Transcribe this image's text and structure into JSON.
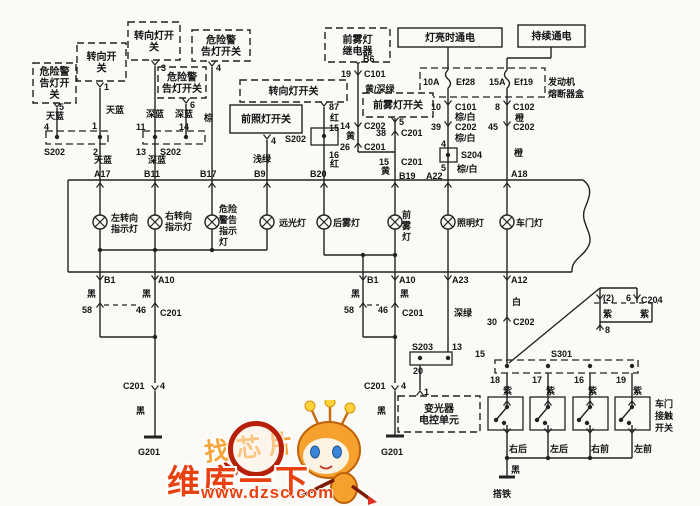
{
  "colors": {
    "line": "#222222",
    "text": "#141414",
    "bg": "#fbfaf7",
    "brand": "#e8400e",
    "slogan": "#f7a53b"
  },
  "watermark": {
    "slogan": "找芯片",
    "brand": "维库一下",
    "url": "www.dzsc.com"
  },
  "boxes": [
    {
      "n": "hazard-warning-light-switch-1",
      "lines": [
        "危险警",
        "告灯开",
        "关"
      ],
      "x": 33,
      "y": 63,
      "w": 43,
      "h": 40,
      "d": 1
    },
    {
      "n": "turn-switch",
      "lines": [
        "转向开",
        "关"
      ],
      "x": 77,
      "y": 43,
      "w": 49,
      "h": 38,
      "d": 1
    },
    {
      "n": "turn-lamp-switch-1",
      "lines": [
        "转向灯开",
        "关"
      ],
      "x": 128,
      "y": 22,
      "w": 52,
      "h": 38,
      "d": 1
    },
    {
      "n": "hazard-warning-light-switch-2",
      "lines": [
        "危险警",
        "告灯开关"
      ],
      "x": 158,
      "y": 67,
      "w": 48,
      "h": 31,
      "d": 1
    },
    {
      "n": "hazard-warning-light-switch-3",
      "lines": [
        "危险警",
        "告灯开关"
      ],
      "x": 192,
      "y": 30,
      "w": 58,
      "h": 31,
      "d": 1
    },
    {
      "n": "turn-lamp-switch-2",
      "lines": [
        "转向灯开关"
      ],
      "x": 240,
      "y": 80,
      "w": 107,
      "h": 22,
      "d": 1
    },
    {
      "n": "headlamp-switch",
      "lines": [
        "前照灯开关"
      ],
      "x": 230,
      "y": 105,
      "w": 72,
      "h": 28,
      "d": 0
    },
    {
      "n": "front-fog-relay",
      "lines": [
        "前雾灯",
        "继电器"
      ],
      "x": 325,
      "y": 28,
      "w": 65,
      "h": 34,
      "d": 1
    },
    {
      "n": "front-fog-switch",
      "lines": [
        "前雾灯开关"
      ],
      "x": 363,
      "y": 93,
      "w": 70,
      "h": 24,
      "d": 1
    },
    {
      "n": "power-when-lights-on",
      "lines": [
        "灯亮时通电"
      ],
      "x": 398,
      "y": 28,
      "w": 104,
      "h": 19,
      "d": 0
    },
    {
      "n": "power-continuous",
      "lines": [
        "持续通电"
      ],
      "x": 518,
      "y": 25,
      "w": 67,
      "h": 22,
      "d": 0
    },
    {
      "n": "dimmer-ecu",
      "lines": [
        "变光器",
        "电控单元"
      ],
      "x": 398,
      "y": 396,
      "w": 82,
      "h": 36,
      "d": 1
    }
  ],
  "texts": [
    {
      "n": "pin",
      "t": "5",
      "x": 59,
      "y": 110
    },
    {
      "n": "wire-color",
      "t": "天蓝",
      "x": 46,
      "y": 119
    },
    {
      "n": "pin",
      "t": "4",
      "x": 44,
      "y": 130
    },
    {
      "n": "pin",
      "t": "1",
      "x": 104,
      "y": 90
    },
    {
      "n": "wire-color",
      "t": "天蓝",
      "x": 106,
      "y": 113
    },
    {
      "n": "pin",
      "t": "1",
      "x": 92,
      "y": 129
    },
    {
      "n": "connector",
      "t": "S202",
      "x": 44,
      "y": 155
    },
    {
      "n": "pin",
      "t": "2",
      "x": 93,
      "y": 155
    },
    {
      "n": "wire-color",
      "t": "天蓝",
      "x": 94,
      "y": 163
    },
    {
      "n": "pin",
      "t": "A17",
      "x": 94,
      "y": 177
    },
    {
      "n": "pin",
      "t": "3",
      "x": 161,
      "y": 71
    },
    {
      "n": "wire-color",
      "t": "深蓝",
      "x": 146,
      "y": 117
    },
    {
      "n": "wire-color",
      "t": "深蓝",
      "x": 175,
      "y": 117
    },
    {
      "n": "pin",
      "t": "11",
      "x": 136,
      "y": 130
    },
    {
      "n": "pin",
      "t": "14",
      "x": 179,
      "y": 130
    },
    {
      "n": "pin",
      "t": "13",
      "x": 136,
      "y": 155
    },
    {
      "n": "connector",
      "t": "S202",
      "x": 160,
      "y": 155
    },
    {
      "n": "wire-color",
      "t": "深蓝",
      "x": 148,
      "y": 163
    },
    {
      "n": "pin",
      "t": "B11",
      "x": 144,
      "y": 177
    },
    {
      "n": "pin",
      "t": "6",
      "x": 190,
      "y": 108
    },
    {
      "n": "wire-color",
      "t": "棕",
      "x": 204,
      "y": 121
    },
    {
      "n": "pin",
      "t": "B17",
      "x": 200,
      "y": 177
    },
    {
      "n": "pin",
      "t": "4",
      "x": 216,
      "y": 71
    },
    {
      "n": "pin",
      "t": "4",
      "x": 271,
      "y": 144
    },
    {
      "n": "wire-color",
      "t": "浅绿",
      "x": 253,
      "y": 162
    },
    {
      "n": "pin",
      "t": "B9",
      "x": 254,
      "y": 177
    },
    {
      "n": "pin",
      "t": "87",
      "x": 329,
      "y": 110
    },
    {
      "n": "wire-color",
      "t": "红",
      "x": 330,
      "y": 121
    },
    {
      "n": "pin",
      "t": "15",
      "x": 329,
      "y": 131
    },
    {
      "n": "connector",
      "t": "S202",
      "x": 285,
      "y": 142
    },
    {
      "n": "pin",
      "t": "16",
      "x": 329,
      "y": 158
    },
    {
      "n": "wire-color",
      "t": "红",
      "x": 330,
      "y": 167
    },
    {
      "n": "pin",
      "t": "B20",
      "x": 310,
      "y": 177
    },
    {
      "n": "pin",
      "t": "B6",
      "x": 363,
      "y": 62
    },
    {
      "n": "pin",
      "t": "19",
      "x": 341,
      "y": 77
    },
    {
      "n": "connector",
      "t": "C101",
      "x": 364,
      "y": 77
    },
    {
      "n": "wire-color",
      "t": "黄/深绿",
      "x": 365,
      "y": 92
    },
    {
      "n": "pin",
      "t": "14",
      "x": 340,
      "y": 129
    },
    {
      "n": "connector",
      "t": "C202",
      "x": 364,
      "y": 129
    },
    {
      "n": "wire-color",
      "t": "黄",
      "x": 346,
      "y": 139
    },
    {
      "n": "pin",
      "t": "26",
      "x": 340,
      "y": 150
    },
    {
      "n": "connector",
      "t": "C201",
      "x": 364,
      "y": 150
    },
    {
      "n": "pin",
      "t": "5",
      "x": 399,
      "y": 125
    },
    {
      "n": "pin",
      "t": "38",
      "x": 376,
      "y": 136
    },
    {
      "n": "connector",
      "t": "C201",
      "x": 401,
      "y": 136
    },
    {
      "n": "pin",
      "t": "15",
      "x": 379,
      "y": 165
    },
    {
      "n": "connector",
      "t": "C201",
      "x": 401,
      "y": 165
    },
    {
      "n": "wire-color",
      "t": "黄",
      "x": 381,
      "y": 174
    },
    {
      "n": "pin",
      "t": "B19",
      "x": 399,
      "y": 179
    },
    {
      "n": "fuse",
      "t": "10A",
      "x": 423,
      "y": 85
    },
    {
      "n": "fuse",
      "t": "Ef28",
      "x": 456,
      "y": 85
    },
    {
      "n": "fuse",
      "t": "15A",
      "x": 489,
      "y": 85
    },
    {
      "n": "fuse",
      "t": "Ef19",
      "x": 514,
      "y": 85
    },
    {
      "n": "pin",
      "t": "10",
      "x": 431,
      "y": 110
    },
    {
      "n": "connector",
      "t": "C101",
      "x": 455,
      "y": 110
    },
    {
      "n": "wire-color",
      "t": "棕/白",
      "x": 455,
      "y": 120
    },
    {
      "n": "pin",
      "t": "39",
      "x": 431,
      "y": 130
    },
    {
      "n": "connector",
      "t": "C202",
      "x": 455,
      "y": 130
    },
    {
      "n": "wire-color",
      "t": "棕/白",
      "x": 455,
      "y": 141
    },
    {
      "n": "pin",
      "t": "4",
      "x": 441,
      "y": 147
    },
    {
      "n": "connector",
      "t": "S204",
      "x": 461,
      "y": 158
    },
    {
      "n": "pin",
      "t": "5",
      "x": 441,
      "y": 171
    },
    {
      "n": "wire-color",
      "t": "棕/白",
      "x": 457,
      "y": 172
    },
    {
      "n": "pin",
      "t": "A22",
      "x": 426,
      "y": 179
    },
    {
      "n": "pin",
      "t": "8",
      "x": 495,
      "y": 110
    },
    {
      "n": "connector",
      "t": "C102",
      "x": 513,
      "y": 110
    },
    {
      "n": "wire-color",
      "t": "橙",
      "x": 515,
      "y": 121
    },
    {
      "n": "pin",
      "t": "45",
      "x": 488,
      "y": 130
    },
    {
      "n": "connector",
      "t": "C202",
      "x": 513,
      "y": 130
    },
    {
      "n": "wire-color",
      "t": "橙",
      "x": 514,
      "y": 156
    },
    {
      "n": "pin",
      "t": "A18",
      "x": 511,
      "y": 177
    },
    {
      "n": "component",
      "t": "发动机",
      "x": 548,
      "y": 85
    },
    {
      "n": "component",
      "t": "熔断器盒",
      "x": 548,
      "y": 97
    },
    {
      "n": "lamp",
      "t": "左转向",
      "x": 111,
      "y": 221
    },
    {
      "n": "lamp",
      "t": "指示灯",
      "x": 111,
      "y": 232
    },
    {
      "n": "lamp",
      "t": "右转向",
      "x": 165,
      "y": 219
    },
    {
      "n": "lamp",
      "t": "指示灯",
      "x": 165,
      "y": 230
    },
    {
      "n": "lamp",
      "t": "危险",
      "x": 219,
      "y": 212
    },
    {
      "n": "lamp",
      "t": "警告",
      "x": 219,
      "y": 223
    },
    {
      "n": "lamp",
      "t": "指示",
      "x": 219,
      "y": 234
    },
    {
      "n": "lamp",
      "t": "灯",
      "x": 219,
      "y": 245
    },
    {
      "n": "lamp",
      "t": "远光灯",
      "x": 279,
      "y": 226
    },
    {
      "n": "lamp",
      "t": "后雾灯",
      "x": 333,
      "y": 226
    },
    {
      "n": "lamp",
      "t": "前",
      "x": 402,
      "y": 218
    },
    {
      "n": "lamp",
      "t": "雾",
      "x": 402,
      "y": 229
    },
    {
      "n": "lamp",
      "t": "灯",
      "x": 402,
      "y": 240
    },
    {
      "n": "lamp",
      "t": "照明灯",
      "x": 457,
      "y": 226
    },
    {
      "n": "lamp",
      "t": "车门灯",
      "x": 516,
      "y": 226
    },
    {
      "n": "pin",
      "t": "B1",
      "x": 104,
      "y": 283
    },
    {
      "n": "pin",
      "t": "A10",
      "x": 158,
      "y": 283
    },
    {
      "n": "wire-color",
      "t": "黑",
      "x": 87,
      "y": 297
    },
    {
      "n": "wire-color",
      "t": "黑",
      "x": 142,
      "y": 297
    },
    {
      "n": "pin",
      "t": "58",
      "x": 82,
      "y": 313
    },
    {
      "n": "pin",
      "t": "46",
      "x": 136,
      "y": 313
    },
    {
      "n": "connector",
      "t": "C201",
      "x": 160,
      "y": 316
    },
    {
      "n": "connector",
      "t": "C201",
      "x": 123,
      "y": 389
    },
    {
      "n": "pin",
      "t": "4",
      "x": 160,
      "y": 389
    },
    {
      "n": "wire-color",
      "t": "黑",
      "x": 136,
      "y": 414
    },
    {
      "n": "ground",
      "t": "G201",
      "x": 138,
      "y": 455
    },
    {
      "n": "pin",
      "t": "B1",
      "x": 367,
      "y": 283
    },
    {
      "n": "pin",
      "t": "A10",
      "x": 399,
      "y": 283
    },
    {
      "n": "wire-color",
      "t": "黑",
      "x": 351,
      "y": 297
    },
    {
      "n": "wire-color",
      "t": "黑",
      "x": 400,
      "y": 297
    },
    {
      "n": "pin",
      "t": "58",
      "x": 344,
      "y": 313
    },
    {
      "n": "pin",
      "t": "46",
      "x": 378,
      "y": 313
    },
    {
      "n": "connector",
      "t": "C201",
      "x": 402,
      "y": 316
    },
    {
      "n": "connector",
      "t": "C201",
      "x": 364,
      "y": 389
    },
    {
      "n": "pin",
      "t": "4",
      "x": 401,
      "y": 389
    },
    {
      "n": "wire-color",
      "t": "黑",
      "x": 377,
      "y": 414
    },
    {
      "n": "ground",
      "t": "G201",
      "x": 381,
      "y": 455
    },
    {
      "n": "pin",
      "t": "A23",
      "x": 452,
      "y": 283
    },
    {
      "n": "wire-color",
      "t": "深绿",
      "x": 454,
      "y": 316
    },
    {
      "n": "connector",
      "t": "S203",
      "x": 412,
      "y": 350
    },
    {
      "n": "pin",
      "t": "13",
      "x": 452,
      "y": 350
    },
    {
      "n": "pin",
      "t": "20",
      "x": 413,
      "y": 374
    },
    {
      "n": "pin",
      "t": "1",
      "x": 424,
      "y": 395
    },
    {
      "n": "pin",
      "t": "A12",
      "x": 511,
      "y": 283
    },
    {
      "n": "wire-color",
      "t": "白",
      "x": 512,
      "y": 305
    },
    {
      "n": "pin",
      "t": "30",
      "x": 487,
      "y": 325
    },
    {
      "n": "connector",
      "t": "C202",
      "x": 513,
      "y": 325
    },
    {
      "n": "pin",
      "t": "15",
      "x": 475,
      "y": 357
    },
    {
      "n": "connector",
      "t": "S301",
      "x": 551,
      "y": 357
    },
    {
      "n": "pin",
      "t": "18",
      "x": 490,
      "y": 383
    },
    {
      "n": "wire-color",
      "t": "紫",
      "x": 503,
      "y": 394
    },
    {
      "n": "pin",
      "t": "17",
      "x": 532,
      "y": 383
    },
    {
      "n": "wire-color",
      "t": "紫",
      "x": 546,
      "y": 394
    },
    {
      "n": "pin",
      "t": "16",
      "x": 574,
      "y": 383
    },
    {
      "n": "wire-color",
      "t": "紫",
      "x": 588,
      "y": 394
    },
    {
      "n": "pin",
      "t": "19",
      "x": 616,
      "y": 383
    },
    {
      "n": "wire-color",
      "t": "紫",
      "x": 633,
      "y": 394
    },
    {
      "n": "component",
      "t": "车门",
      "x": 655,
      "y": 407
    },
    {
      "n": "component",
      "t": "接触",
      "x": 655,
      "y": 419
    },
    {
      "n": "component",
      "t": "开关",
      "x": 655,
      "y": 431
    },
    {
      "n": "component",
      "t": "右后",
      "x": 509,
      "y": 452
    },
    {
      "n": "component",
      "t": "左后",
      "x": 550,
      "y": 452
    },
    {
      "n": "component",
      "t": "右前",
      "x": 591,
      "y": 452
    },
    {
      "n": "component",
      "t": "左前",
      "x": 634,
      "y": 452
    },
    {
      "n": "wire-color",
      "t": "黑",
      "x": 511,
      "y": 473
    },
    {
      "n": "ground",
      "t": "搭铁",
      "x": 493,
      "y": 497
    },
    {
      "n": "pin",
      "t": "(2)",
      "x": 603,
      "y": 301
    },
    {
      "n": "pin",
      "t": "6",
      "x": 626,
      "y": 301
    },
    {
      "n": "connector",
      "t": "C204",
      "x": 641,
      "y": 303
    },
    {
      "n": "wire-color",
      "t": "紫",
      "x": 603,
      "y": 317
    },
    {
      "n": "wire-color",
      "t": "紫",
      "x": 640,
      "y": 317
    },
    {
      "n": "pin",
      "t": "8",
      "x": 605,
      "y": 333
    }
  ]
}
